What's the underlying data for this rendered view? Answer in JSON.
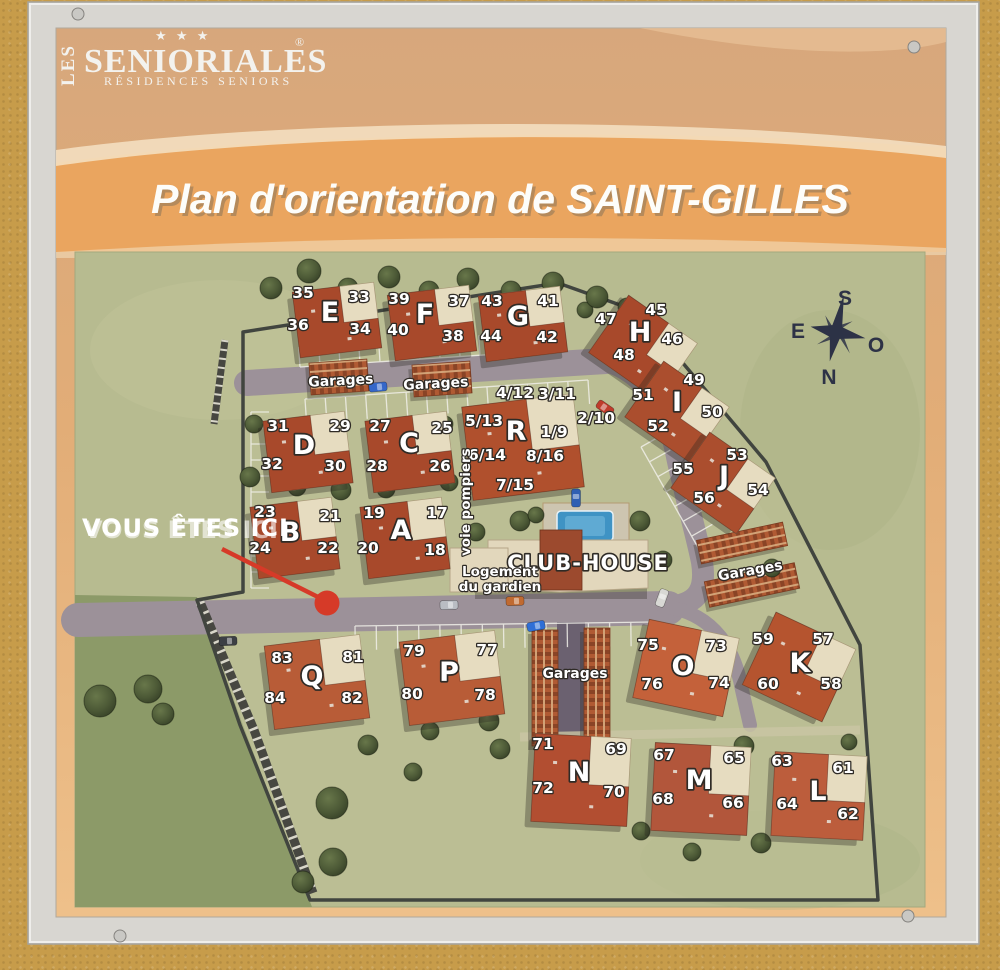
{
  "sign": {
    "logo": {
      "les": "LES",
      "name": "SENIORIALES",
      "reg": "®",
      "stars": "★ ★ ★",
      "subtitle": "RÉSIDENCES SENIORS"
    },
    "title": "Plan d'orientation de SAINT-GILLES"
  },
  "map": {
    "you_are_here": "VOUS ÊTES ICI",
    "club_house": "CLUB-HOUSE",
    "guard_line1": "Logement",
    "guard_line2": "du gardien",
    "fire_lane": "voie pompiers",
    "garages_label": "Garages",
    "compass": {
      "s": "S",
      "e": "E",
      "o": "O",
      "n": "N"
    },
    "colors": {
      "wall": "#c79c4a",
      "frame": "#d8d6d1",
      "header_tan": "#d7a77c",
      "title_band": "#eaa55f",
      "grass": "#b7bb90",
      "grass_dark": "#8c9a68",
      "road": "#9c9199",
      "roof_red": "#a8492b",
      "beige": "#e6dcc0",
      "marker_red": "#d63a28",
      "pool_blue": "#3f93c4",
      "compass_navy": "#2d3246"
    },
    "letters": [
      {
        "t": "E",
        "x": 330,
        "y": 321
      },
      {
        "t": "F",
        "x": 425,
        "y": 323
      },
      {
        "t": "G",
        "x": 518,
        "y": 325
      },
      {
        "t": "H",
        "x": 640,
        "y": 341
      },
      {
        "t": "I",
        "x": 677,
        "y": 411
      },
      {
        "t": "J",
        "x": 724,
        "y": 485
      },
      {
        "t": "R",
        "x": 516,
        "y": 440
      },
      {
        "t": "D",
        "x": 304,
        "y": 454
      },
      {
        "t": "C",
        "x": 409,
        "y": 452
      },
      {
        "t": "B",
        "x": 290,
        "y": 541
      },
      {
        "t": "A",
        "x": 401,
        "y": 539
      },
      {
        "t": "Q",
        "x": 312,
        "y": 685
      },
      {
        "t": "P",
        "x": 449,
        "y": 681
      },
      {
        "t": "O",
        "x": 683,
        "y": 675
      },
      {
        "t": "K",
        "x": 800,
        "y": 672
      },
      {
        "t": "N",
        "x": 579,
        "y": 781
      },
      {
        "t": "M",
        "x": 699,
        "y": 789
      },
      {
        "t": "L",
        "x": 818,
        "y": 800
      }
    ],
    "units": [
      {
        "t": "35",
        "x": 303,
        "y": 298
      },
      {
        "t": "36",
        "x": 298,
        "y": 330
      },
      {
        "t": "33",
        "x": 359,
        "y": 302
      },
      {
        "t": "34",
        "x": 360,
        "y": 334
      },
      {
        "t": "39",
        "x": 399,
        "y": 304
      },
      {
        "t": "40",
        "x": 398,
        "y": 335
      },
      {
        "t": "37",
        "x": 459,
        "y": 306
      },
      {
        "t": "38",
        "x": 453,
        "y": 341
      },
      {
        "t": "43",
        "x": 492,
        "y": 306
      },
      {
        "t": "44",
        "x": 491,
        "y": 341
      },
      {
        "t": "41",
        "x": 548,
        "y": 306
      },
      {
        "t": "42",
        "x": 547,
        "y": 342
      },
      {
        "t": "47",
        "x": 606,
        "y": 324
      },
      {
        "t": "48",
        "x": 624,
        "y": 360
      },
      {
        "t": "45",
        "x": 656,
        "y": 315
      },
      {
        "t": "46",
        "x": 672,
        "y": 344
      },
      {
        "t": "51",
        "x": 643,
        "y": 400
      },
      {
        "t": "52",
        "x": 658,
        "y": 431
      },
      {
        "t": "49",
        "x": 694,
        "y": 385
      },
      {
        "t": "50",
        "x": 712,
        "y": 417
      },
      {
        "t": "55",
        "x": 683,
        "y": 474
      },
      {
        "t": "56",
        "x": 704,
        "y": 503
      },
      {
        "t": "53",
        "x": 737,
        "y": 460
      },
      {
        "t": "54",
        "x": 758,
        "y": 495
      },
      {
        "t": "4/12",
        "x": 515,
        "y": 398
      },
      {
        "t": "3/11",
        "x": 557,
        "y": 399
      },
      {
        "t": "5/13",
        "x": 484,
        "y": 426
      },
      {
        "t": "2/10",
        "x": 596,
        "y": 423
      },
      {
        "t": "1/9",
        "x": 554,
        "y": 437
      },
      {
        "t": "6/14",
        "x": 487,
        "y": 460
      },
      {
        "t": "8/16",
        "x": 545,
        "y": 461
      },
      {
        "t": "7/15",
        "x": 515,
        "y": 490
      },
      {
        "t": "31",
        "x": 278,
        "y": 431
      },
      {
        "t": "32",
        "x": 272,
        "y": 469
      },
      {
        "t": "29",
        "x": 340,
        "y": 431
      },
      {
        "t": "30",
        "x": 335,
        "y": 471
      },
      {
        "t": "27",
        "x": 380,
        "y": 431
      },
      {
        "t": "28",
        "x": 377,
        "y": 471
      },
      {
        "t": "25",
        "x": 442,
        "y": 433
      },
      {
        "t": "26",
        "x": 440,
        "y": 471
      },
      {
        "t": "23",
        "x": 265,
        "y": 517
      },
      {
        "t": "24",
        "x": 260,
        "y": 553
      },
      {
        "t": "21",
        "x": 330,
        "y": 521
      },
      {
        "t": "22",
        "x": 328,
        "y": 553
      },
      {
        "t": "19",
        "x": 374,
        "y": 518
      },
      {
        "t": "20",
        "x": 368,
        "y": 553
      },
      {
        "t": "17",
        "x": 437,
        "y": 518
      },
      {
        "t": "18",
        "x": 435,
        "y": 555
      },
      {
        "t": "83",
        "x": 282,
        "y": 663
      },
      {
        "t": "84",
        "x": 275,
        "y": 703
      },
      {
        "t": "81",
        "x": 353,
        "y": 662
      },
      {
        "t": "82",
        "x": 352,
        "y": 703
      },
      {
        "t": "79",
        "x": 414,
        "y": 656
      },
      {
        "t": "80",
        "x": 412,
        "y": 699
      },
      {
        "t": "77",
        "x": 487,
        "y": 655
      },
      {
        "t": "78",
        "x": 485,
        "y": 700
      },
      {
        "t": "75",
        "x": 648,
        "y": 650
      },
      {
        "t": "76",
        "x": 652,
        "y": 689
      },
      {
        "t": "73",
        "x": 716,
        "y": 651
      },
      {
        "t": "74",
        "x": 719,
        "y": 688
      },
      {
        "t": "59",
        "x": 763,
        "y": 644
      },
      {
        "t": "60",
        "x": 768,
        "y": 689
      },
      {
        "t": "57",
        "x": 823,
        "y": 644
      },
      {
        "t": "58",
        "x": 831,
        "y": 689
      },
      {
        "t": "71",
        "x": 543,
        "y": 749
      },
      {
        "t": "72",
        "x": 543,
        "y": 793
      },
      {
        "t": "69",
        "x": 616,
        "y": 754
      },
      {
        "t": "70",
        "x": 614,
        "y": 797
      },
      {
        "t": "67",
        "x": 664,
        "y": 760
      },
      {
        "t": "68",
        "x": 663,
        "y": 804
      },
      {
        "t": "65",
        "x": 734,
        "y": 763
      },
      {
        "t": "66",
        "x": 733,
        "y": 808
      },
      {
        "t": "63",
        "x": 782,
        "y": 766
      },
      {
        "t": "64",
        "x": 787,
        "y": 809
      },
      {
        "t": "61",
        "x": 843,
        "y": 773
      },
      {
        "t": "62",
        "x": 848,
        "y": 819
      }
    ],
    "buildings": [
      {
        "id": "e",
        "x": 337,
        "y": 320,
        "w": 82,
        "h": 66,
        "r": -7,
        "roof": "#a8492b"
      },
      {
        "id": "f",
        "x": 432,
        "y": 323,
        "w": 82,
        "h": 66,
        "r": -7,
        "roof": "#a8492b"
      },
      {
        "id": "g",
        "x": 523,
        "y": 324,
        "w": 82,
        "h": 66,
        "r": -7,
        "roof": "#a8492b"
      },
      {
        "id": "h",
        "x": 643,
        "y": 348,
        "w": 84,
        "h": 70,
        "r": 35,
        "roof": "#a8492b"
      },
      {
        "id": "i",
        "x": 677,
        "y": 412,
        "w": 80,
        "h": 68,
        "r": 35,
        "roof": "#ab4e2e"
      },
      {
        "id": "j",
        "x": 723,
        "y": 483,
        "w": 80,
        "h": 68,
        "r": 35,
        "roof": "#ab4e2e"
      },
      {
        "id": "r",
        "x": 523,
        "y": 447,
        "w": 112,
        "h": 94,
        "r": -7,
        "roof": "#b0502d"
      },
      {
        "id": "d",
        "x": 308,
        "y": 452,
        "w": 82,
        "h": 72,
        "r": -7,
        "roof": "#a8492b"
      },
      {
        "id": "c",
        "x": 410,
        "y": 452,
        "w": 82,
        "h": 72,
        "r": -7,
        "roof": "#a8492b"
      },
      {
        "id": "b",
        "x": 295,
        "y": 538,
        "w": 82,
        "h": 72,
        "r": -7,
        "roof": "#a8492b"
      },
      {
        "id": "a",
        "x": 405,
        "y": 538,
        "w": 82,
        "h": 72,
        "r": -7,
        "roof": "#a8492b"
      },
      {
        "id": "q",
        "x": 317,
        "y": 682,
        "w": 96,
        "h": 84,
        "r": -7,
        "roof": "#b85c37"
      },
      {
        "id": "p",
        "x": 452,
        "y": 678,
        "w": 96,
        "h": 84,
        "r": -7,
        "roof": "#b85c37"
      },
      {
        "id": "o",
        "x": 686,
        "y": 668,
        "w": 92,
        "h": 80,
        "r": 12,
        "roof": "#c4613a"
      },
      {
        "id": "k",
        "x": 799,
        "y": 667,
        "w": 88,
        "h": 80,
        "r": 25,
        "roof": "#b5542f"
      },
      {
        "id": "n",
        "x": 581,
        "y": 780,
        "w": 96,
        "h": 88,
        "r": 3,
        "roof": "#b24e31"
      },
      {
        "id": "m",
        "x": 701,
        "y": 789,
        "w": 96,
        "h": 88,
        "r": 3,
        "roof": "#b2563b"
      },
      {
        "id": "l",
        "x": 819,
        "y": 796,
        "w": 92,
        "h": 84,
        "r": 3,
        "roof": "#bc5d3c"
      }
    ],
    "garages": [
      {
        "x": 339,
        "y": 377,
        "w": 58,
        "h": 32,
        "r": -4,
        "v": "h"
      },
      {
        "x": 442,
        "y": 379,
        "w": 58,
        "h": 32,
        "r": -4,
        "v": "h"
      },
      {
        "x": 742,
        "y": 543,
        "w": 88,
        "h": 24,
        "r": -12,
        "v": "h"
      },
      {
        "x": 752,
        "y": 585,
        "w": 92,
        "h": 26,
        "r": -12,
        "v": "h"
      },
      {
        "x": 545,
        "y": 688,
        "w": 26,
        "h": 116,
        "r": 0,
        "v": "v"
      },
      {
        "x": 597,
        "y": 686,
        "w": 26,
        "h": 116,
        "r": 0,
        "v": "v"
      }
    ],
    "garage_labels": [
      {
        "x": 341,
        "y": 385,
        "r": -3
      },
      {
        "x": 436,
        "y": 388,
        "r": -3
      },
      {
        "x": 751,
        "y": 575,
        "r": -10
      },
      {
        "x": 575,
        "y": 678,
        "r": 0
      }
    ],
    "trees": [
      [
        271,
        288,
        11
      ],
      [
        309,
        271,
        12
      ],
      [
        348,
        288,
        10
      ],
      [
        389,
        277,
        11
      ],
      [
        429,
        291,
        10
      ],
      [
        468,
        279,
        11
      ],
      [
        511,
        291,
        10
      ],
      [
        553,
        283,
        11
      ],
      [
        585,
        310,
        8
      ],
      [
        597,
        297,
        11
      ],
      [
        627,
        307,
        9
      ],
      [
        656,
        372,
        9
      ],
      [
        700,
        437,
        9
      ],
      [
        733,
        512,
        9
      ],
      [
        772,
        568,
        9
      ],
      [
        254,
        424,
        9
      ],
      [
        250,
        477,
        10
      ],
      [
        297,
        487,
        9
      ],
      [
        341,
        490,
        10
      ],
      [
        386,
        489,
        9
      ],
      [
        445,
        424,
        8
      ],
      [
        449,
        482,
        9
      ],
      [
        520,
        521,
        10
      ],
      [
        476,
        532,
        9
      ],
      [
        536,
        515,
        8
      ],
      [
        640,
        521,
        10
      ],
      [
        663,
        560,
        9
      ],
      [
        100,
        701,
        16
      ],
      [
        148,
        689,
        14
      ],
      [
        163,
        714,
        11
      ],
      [
        332,
        803,
        16
      ],
      [
        333,
        862,
        14
      ],
      [
        303,
        882,
        11
      ],
      [
        489,
        721,
        10
      ],
      [
        500,
        749,
        10
      ],
      [
        430,
        731,
        9
      ],
      [
        368,
        745,
        10
      ],
      [
        413,
        772,
        9
      ],
      [
        744,
        746,
        10
      ],
      [
        722,
        812,
        10
      ],
      [
        761,
        843,
        10
      ],
      [
        692,
        852,
        9
      ],
      [
        641,
        831,
        9
      ],
      [
        849,
        742,
        8
      ]
    ],
    "cars": [
      [
        378,
        387,
        85,
        "#3567c9"
      ],
      [
        605,
        408,
        -55,
        "#bf3b2b"
      ],
      [
        576,
        498,
        0,
        "#2f5fb3"
      ],
      [
        515,
        601,
        88,
        "#c06a31"
      ],
      [
        449,
        605,
        88,
        "#b9bdc3"
      ],
      [
        536,
        626,
        80,
        "#2f6fd6"
      ],
      [
        228,
        641,
        88,
        "#3c3f44"
      ],
      [
        662,
        598,
        20,
        "#d8d8d4"
      ]
    ],
    "parking": [
      {
        "x1": 305,
        "y1": 399,
        "x2": 588,
        "y2": 380,
        "len": 24,
        "n": 14
      },
      {
        "x1": 300,
        "y1": 367,
        "x2": 560,
        "y2": 350,
        "len": -20,
        "n": 13
      },
      {
        "x1": 251,
        "y1": 412,
        "x2": 251,
        "y2": 588,
        "len": -18,
        "n": 11
      },
      {
        "x1": 355,
        "y1": 626,
        "x2": 652,
        "y2": 622,
        "len": 24,
        "n": 14
      },
      {
        "x1": 641,
        "y1": 447,
        "x2": 700,
        "y2": 551,
        "len": -24,
        "n": 7
      }
    ]
  }
}
